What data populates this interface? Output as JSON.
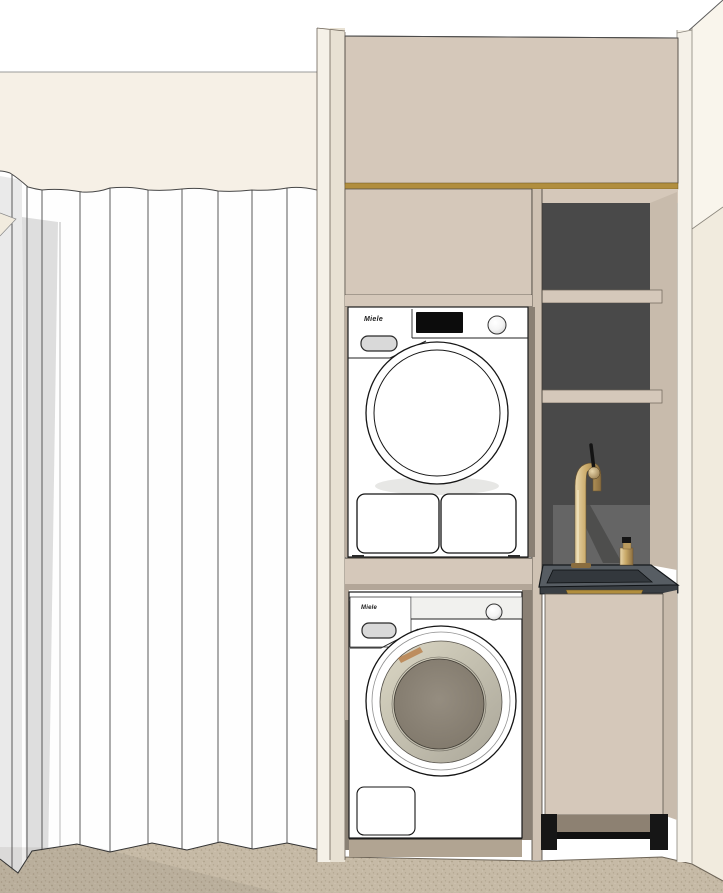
{
  "title": "Laundry closet interior 3D render",
  "labels": {
    "dryer_brand": "Miele",
    "washer_brand": "Miele"
  },
  "colors": {
    "wall_white": "#ffffff",
    "wall_cream": "#f9f5ec",
    "wall_cream_shade": "#f1ebde",
    "valance": "#f6f0e6",
    "curtain": "#fefefe",
    "curtain_shade_a": "#eaeaea",
    "curtain_shade_b": "#dedede",
    "stile_light": "#f5f1e8",
    "stile_dark": "#e8e1d3",
    "cabinet_beige": "#d5c8ba",
    "cabinet_beige_shade": "#c8bbac",
    "partition": "#cfc2b3",
    "gold": "#b18e3e",
    "niche_dark": "#494949",
    "niche_reflection": "#6a6a6a",
    "counter_top": "#575d63",
    "counter_face": "#3a3f44",
    "basin": "#33383d",
    "brass_light": "#e8d6ab",
    "brass_mid": "#c9a968",
    "brass_dark": "#8a6d3f",
    "black_detail": "#151515",
    "appliance_white": "#ffffff",
    "fascia": "#f1f1ee",
    "pill": "#d9d9d9",
    "display": "#0c0c0c",
    "glass_ring_light": "#dbd7c4",
    "glass_ring_dark": "#aaa699",
    "drum_light": "#958d80",
    "drum_dark": "#7c7467",
    "copper": "#b5773f",
    "floor": "#c6baa6",
    "floor_speck_dark": "#8f8269",
    "floor_speck_mid": "#988b74",
    "floor_speck_light": "#d8cfbd",
    "shadow_taupe": "#b1a492",
    "toe_recess": "#8d8172",
    "leg_black": "#161616",
    "outline": "#1a1a1a"
  },
  "scene": {
    "left_area": {
      "name": "accordion folding curtain with valance",
      "panel_count": 10
    },
    "cabinet": {
      "upper": "closed beige panel with brass trim",
      "appliance_column": "stacked dryer over washer",
      "right_column": "open shelves over sink with brass faucet",
      "base": "black legs on carpet"
    },
    "floor": "beige speckled carpet"
  }
}
